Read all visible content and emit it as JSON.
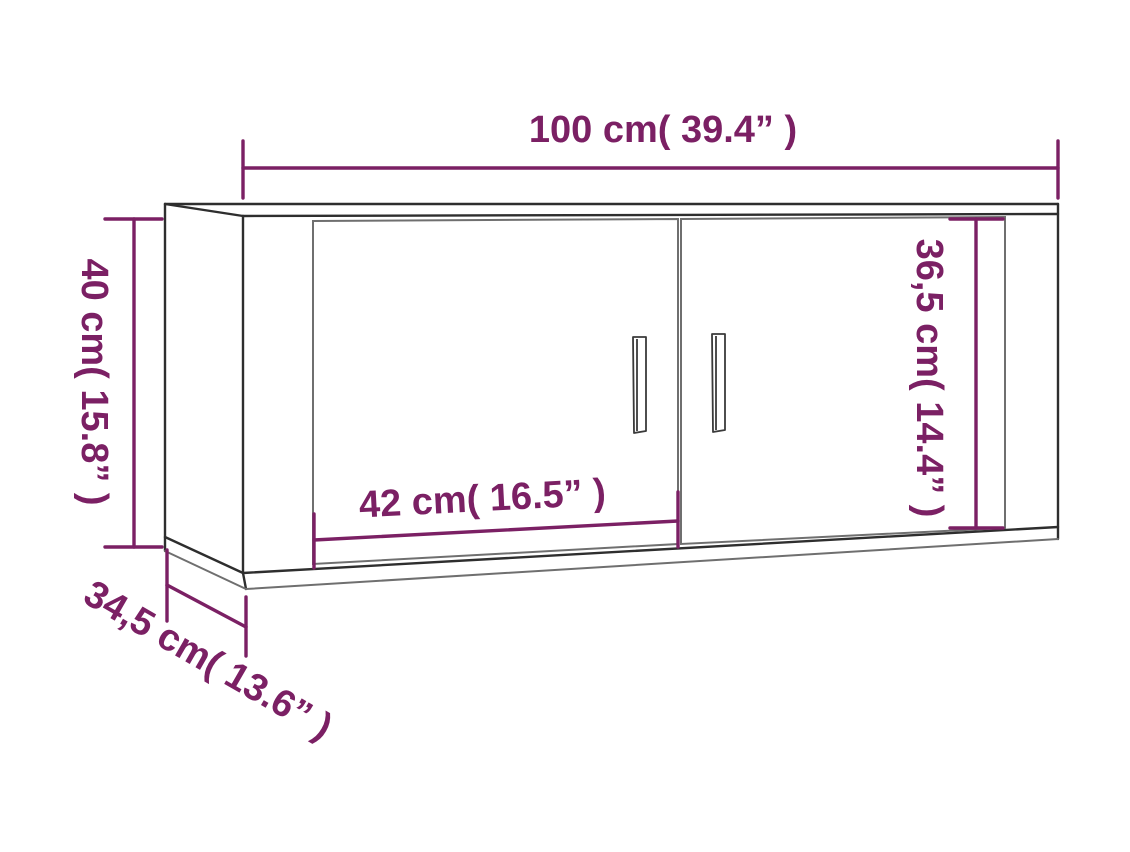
{
  "diagram": {
    "description": "Wall-mounted TV cabinet dimension drawing with two doors and handles",
    "labels": {
      "width": "100 cm( 39.4” )",
      "height": "40 cm( 15.8” )",
      "depth": "34,5 cm( 13.6” )",
      "door_width": "42 cm( 16.5” )",
      "door_height": "36,5 cm( 14.4” )"
    },
    "measurements": {
      "width_cm": "100",
      "width_in": "39.4",
      "height_cm": "40",
      "height_in": "15.8",
      "depth_cm": "34,5",
      "depth_in": "13.6",
      "door_width_cm": "42",
      "door_width_in": "16.5",
      "door_height_cm": "36,5",
      "door_height_in": "14.4"
    },
    "colors": {
      "dimension": "#7b2064",
      "outline_dark": "#2e2e2e",
      "outline_gray": "#6f6f6f",
      "background": "#ffffff"
    }
  }
}
